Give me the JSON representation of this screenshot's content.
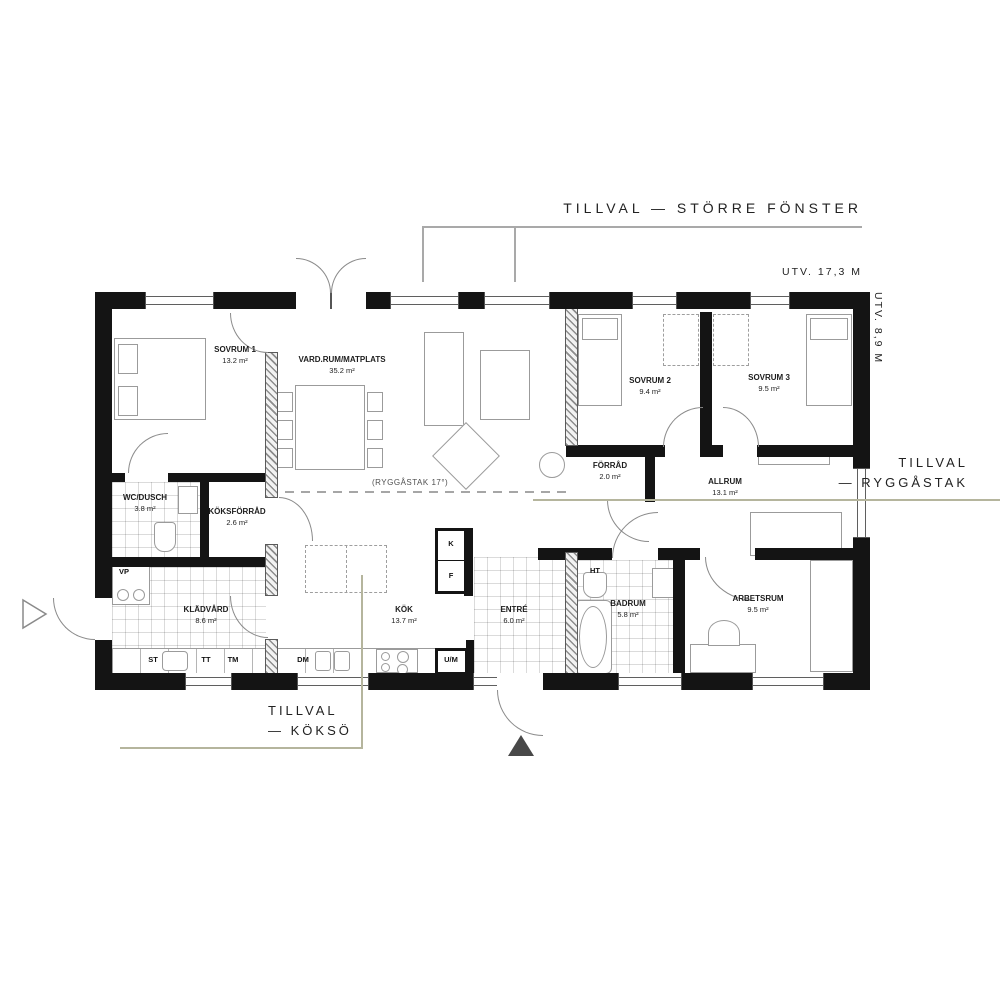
{
  "annotations": {
    "larger_windows": {
      "label": "TILLVAL — STÖRRE FÖNSTER"
    },
    "ridge_right": {
      "line1": "TILLVAL",
      "line2": "— RYGGÅSTAK"
    },
    "kitchen_island": {
      "line1": "TILLVAL",
      "line2": "— KÖKSÖ"
    },
    "width_dim": "UTV. 17,3 M",
    "height_dim": "UTV. 8,9 M",
    "ridge_note": "(RYGGÅSTAK 17°)"
  },
  "rooms": {
    "sovrum1": {
      "name": "SOVRUM 1",
      "area": "13.2 m²"
    },
    "vardagsrum": {
      "name": "VARD.RUM/MATPLATS",
      "area": "35.2 m²"
    },
    "sovrum2": {
      "name": "SOVRUM 2",
      "area": "9.4 m²"
    },
    "sovrum3": {
      "name": "SOVRUM 3",
      "area": "9.5 m²"
    },
    "wc_dusch": {
      "name": "WC/DUSCH",
      "area": "3.8 m²"
    },
    "koksforrad": {
      "name": "KÖKSFÖRRÅD",
      "area": "2.6 m²"
    },
    "forrad": {
      "name": "FÖRRÅD",
      "area": "2.0 m²"
    },
    "allrum": {
      "name": "ALLRUM",
      "area": "13.1 m²"
    },
    "kladvard": {
      "name": "KLÄDVÅRD",
      "area": "8.6 m²"
    },
    "kok": {
      "name": "KÖK",
      "area": "13.7 m²"
    },
    "entre": {
      "name": "ENTRÉ",
      "area": "6.0 m²"
    },
    "badrum": {
      "name": "BADRUM",
      "area": "5.8 m²"
    },
    "arbetsrum": {
      "name": "ARBETSRUM",
      "area": "9.5 m²"
    }
  },
  "appliances": {
    "vp": "VP",
    "st": "ST",
    "tt": "TT",
    "tm": "TM",
    "dm": "DM",
    "um": "U/M",
    "k": "K",
    "f": "F",
    "ht": "HT"
  },
  "colors": {
    "wall": "#141414",
    "annotation_line": "#b5b59d",
    "leader_line": "#a9a9a9",
    "text": "#222222"
  }
}
